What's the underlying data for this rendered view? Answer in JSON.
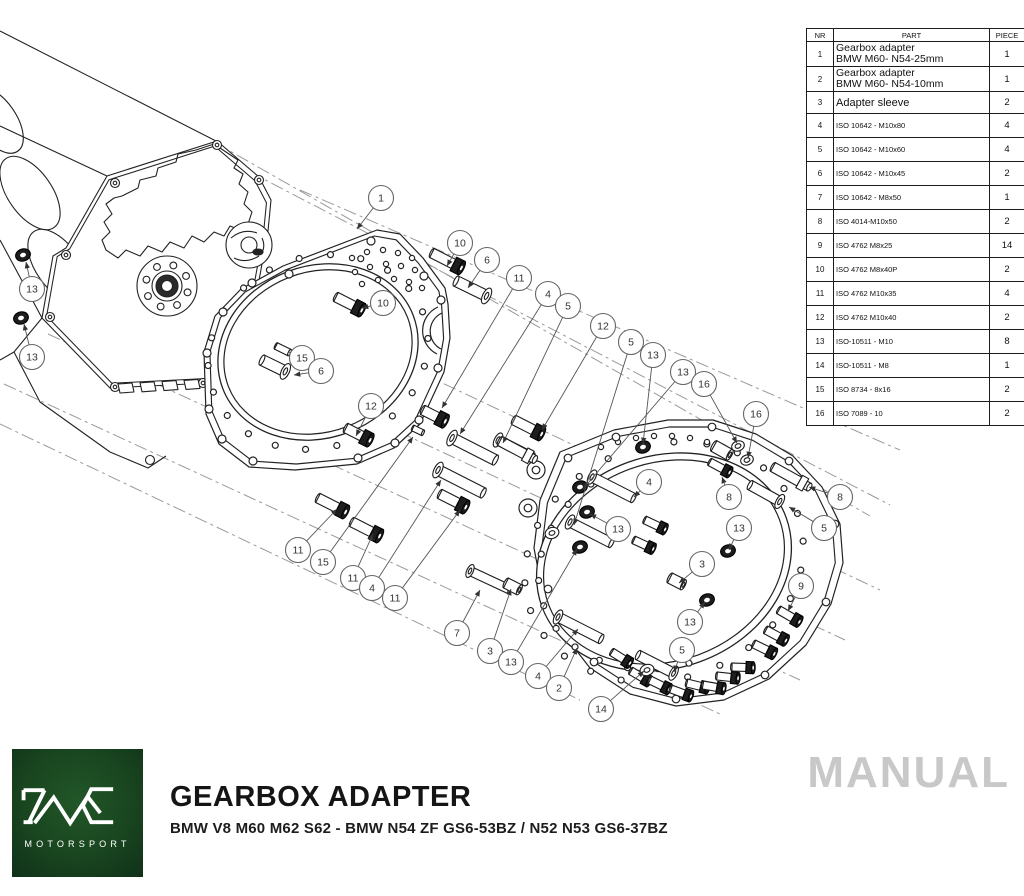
{
  "parts_table": {
    "headers": [
      "NR",
      "PART",
      "PIECE"
    ],
    "rows": [
      {
        "nr": "1",
        "part_lines": [
          "Gearbox adapter",
          "BMW M60- N54-25mm"
        ],
        "piece": "1",
        "size": "lg"
      },
      {
        "nr": "2",
        "part_lines": [
          "Gearbox adapter",
          "BMW M60- N54-10mm"
        ],
        "piece": "1",
        "size": "lg"
      },
      {
        "nr": "3",
        "part_lines": [
          "Adapter sleeve"
        ],
        "piece": "2",
        "size": "md"
      },
      {
        "nr": "4",
        "part_lines": [
          "ISO 10642 - M10x80"
        ],
        "piece": "4",
        "size": "sm"
      },
      {
        "nr": "5",
        "part_lines": [
          "ISO 10642 - M10x60"
        ],
        "piece": "4",
        "size": "sm"
      },
      {
        "nr": "6",
        "part_lines": [
          "ISO 10642 - M10x45"
        ],
        "piece": "2",
        "size": "sm"
      },
      {
        "nr": "7",
        "part_lines": [
          "ISO 10642 - M8x50"
        ],
        "piece": "1",
        "size": "sm"
      },
      {
        "nr": "8",
        "part_lines": [
          "ISO 4014-M10x50"
        ],
        "piece": "2",
        "size": "sm"
      },
      {
        "nr": "9",
        "part_lines": [
          "ISO 4762 M8x25"
        ],
        "piece": "14",
        "size": "sm"
      },
      {
        "nr": "10",
        "part_lines": [
          "ISO 4762 M8x40P"
        ],
        "piece": "2",
        "size": "sm"
      },
      {
        "nr": "11",
        "part_lines": [
          "ISO 4762 M10x35"
        ],
        "piece": "4",
        "size": "sm"
      },
      {
        "nr": "12",
        "part_lines": [
          "ISO 4762 M10x40"
        ],
        "piece": "2",
        "size": "sm"
      },
      {
        "nr": "13",
        "part_lines": [
          "ISO-10511 - M10"
        ],
        "piece": "8",
        "size": "sm"
      },
      {
        "nr": "14",
        "part_lines": [
          "ISO-10511 - M8"
        ],
        "piece": "1",
        "size": "sm"
      },
      {
        "nr": "15",
        "part_lines": [
          "ISO 8734 - 8x16"
        ],
        "piece": "2",
        "size": "sm"
      },
      {
        "nr": "16",
        "part_lines": [
          "ISO 7089 - 10"
        ],
        "piece": "2",
        "size": "sm"
      }
    ]
  },
  "balloons": [
    {
      "n": "13",
      "x": 32,
      "y": 289,
      "tx": 26,
      "ty": 262
    },
    {
      "n": "13",
      "x": 32,
      "y": 357,
      "tx": 24,
      "ty": 324
    },
    {
      "n": "1",
      "x": 381,
      "y": 198,
      "tx": 357,
      "ty": 229
    },
    {
      "n": "10",
      "x": 460,
      "y": 243,
      "tx": 447,
      "ty": 266
    },
    {
      "n": "6",
      "x": 487,
      "y": 260,
      "tx": 468,
      "ty": 288
    },
    {
      "n": "11",
      "x": 519,
      "y": 278,
      "tx": 442,
      "ty": 408
    },
    {
      "n": "4",
      "x": 548,
      "y": 294,
      "tx": 460,
      "ty": 434
    },
    {
      "n": "5",
      "x": 568,
      "y": 306,
      "tx": 503,
      "ty": 443
    },
    {
      "n": "12",
      "x": 603,
      "y": 326,
      "tx": 542,
      "ty": 430
    },
    {
      "n": "5",
      "x": 631,
      "y": 342,
      "tx": 574,
      "ty": 525
    },
    {
      "n": "13",
      "x": 653,
      "y": 355,
      "tx": 643,
      "ty": 444
    },
    {
      "n": "13",
      "x": 683,
      "y": 372,
      "tx": 583,
      "ty": 489
    },
    {
      "n": "16",
      "x": 704,
      "y": 384,
      "tx": 737,
      "ty": 443
    },
    {
      "n": "16",
      "x": 756,
      "y": 414,
      "tx": 748,
      "ty": 458
    },
    {
      "n": "10",
      "x": 383,
      "y": 303,
      "tx": 362,
      "ty": 308
    },
    {
      "n": "15",
      "x": 302,
      "y": 358,
      "tx": 289,
      "ty": 352
    },
    {
      "n": "6",
      "x": 321,
      "y": 371,
      "tx": 294,
      "ty": 375
    },
    {
      "n": "12",
      "x": 371,
      "y": 406,
      "tx": 356,
      "ty": 436
    },
    {
      "n": "11",
      "x": 298,
      "y": 550,
      "tx": 337,
      "ty": 509
    },
    {
      "n": "15",
      "x": 323,
      "y": 562,
      "tx": 413,
      "ty": 437
    },
    {
      "n": "11",
      "x": 353,
      "y": 578,
      "tx": 373,
      "ty": 534
    },
    {
      "n": "4",
      "x": 372,
      "y": 588,
      "tx": 441,
      "ty": 480
    },
    {
      "n": "11",
      "x": 395,
      "y": 598,
      "tx": 460,
      "ty": 510
    },
    {
      "n": "7",
      "x": 457,
      "y": 633,
      "tx": 480,
      "ty": 590
    },
    {
      "n": "3",
      "x": 490,
      "y": 651,
      "tx": 511,
      "ty": 589
    },
    {
      "n": "13",
      "x": 511,
      "y": 662,
      "tx": 577,
      "ty": 549
    },
    {
      "n": "4",
      "x": 538,
      "y": 676,
      "tx": 578,
      "ty": 629
    },
    {
      "n": "2",
      "x": 559,
      "y": 688,
      "tx": 577,
      "ty": 648
    },
    {
      "n": "14",
      "x": 601,
      "y": 709,
      "tx": 644,
      "ty": 671
    },
    {
      "n": "5",
      "x": 682,
      "y": 650,
      "tx": 674,
      "ty": 672
    },
    {
      "n": "13",
      "x": 690,
      "y": 622,
      "tx": 705,
      "ty": 602
    },
    {
      "n": "3",
      "x": 702,
      "y": 564,
      "tx": 679,
      "ty": 583
    },
    {
      "n": "13",
      "x": 618,
      "y": 529,
      "tx": 590,
      "ty": 514
    },
    {
      "n": "13",
      "x": 739,
      "y": 528,
      "tx": 729,
      "ty": 550
    },
    {
      "n": "4",
      "x": 649,
      "y": 482,
      "tx": 634,
      "ty": 497
    },
    {
      "n": "8",
      "x": 729,
      "y": 497,
      "tx": 722,
      "ty": 477
    },
    {
      "n": "8",
      "x": 840,
      "y": 497,
      "tx": 809,
      "ty": 487
    },
    {
      "n": "5",
      "x": 824,
      "y": 528,
      "tx": 789,
      "ty": 507
    },
    {
      "n": "9",
      "x": 801,
      "y": 586,
      "tx": 788,
      "ty": 611
    }
  ],
  "footer": {
    "title": "GEARBOX ADAPTER",
    "subtitle": "BMW V8 M60 M62 S62 - BMW N54 ZF GS6-53BZ / N52 N53 GS6-37BZ",
    "watermark": "MANUAL",
    "logo_monogram": "PMC",
    "logo_text": "MOTORSPORT"
  },
  "colors": {
    "line": "#1c1c1c",
    "construction_line": "#999999",
    "logo_green": "#19451f",
    "watermark_gray": "#c8c8c8"
  }
}
